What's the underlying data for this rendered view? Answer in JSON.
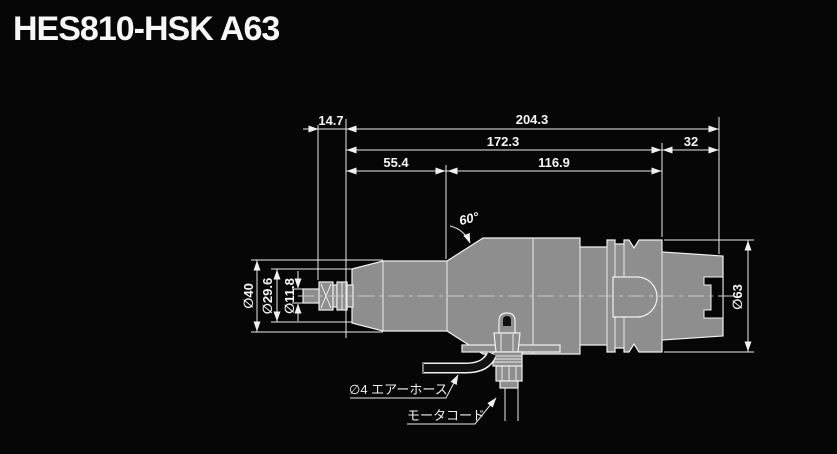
{
  "title": "HES810-HSK A63",
  "drawing": {
    "dimensions": {
      "top_row": {
        "chuck_overhang": "14.7",
        "overall_length": "204.3"
      },
      "mid_row": {
        "body_length": "172.3",
        "shank_length": "32"
      },
      "low_row": {
        "front_length": "55.4",
        "rear_length": "116.9"
      },
      "shoulder_angle": "60°",
      "diameters": {
        "front_body": "∅40",
        "nose_tip": "∅29.6",
        "shaft": "∅11.8",
        "shank_flange": "∅63"
      }
    },
    "callouts": {
      "air_hose": "∅4 エアーホース",
      "motor_cord": "モータコード"
    },
    "colors": {
      "background": "#060606",
      "body_fill": "#8e8e8e",
      "outline": "#f0f0f0",
      "dimension_line": "#e9e9e9",
      "centerline": "#c9c9c9",
      "text": "#f5f5f5"
    }
  }
}
